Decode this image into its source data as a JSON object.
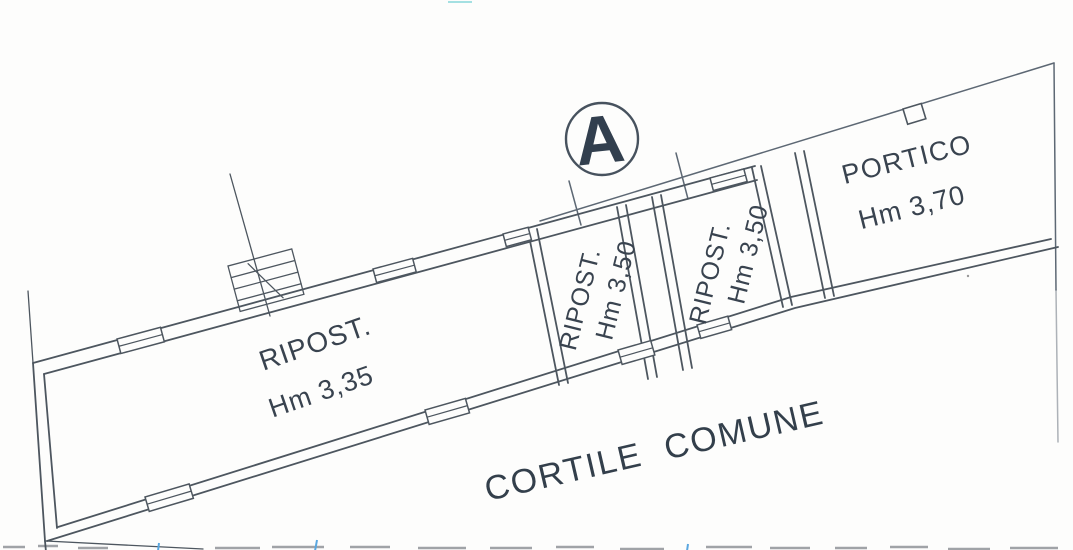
{
  "drawing": {
    "unit_badge": "A",
    "rooms": [
      {
        "label": "RIPOST.",
        "height": "Hm 3,35"
      },
      {
        "label": "RIPOST.",
        "height": "Hm 3,50"
      },
      {
        "label": "RIPOST.",
        "height": "Hm 3,50"
      },
      {
        "label": "PORTICO",
        "height": "Hm 3,70"
      }
    ],
    "courtyard_label": "CORTILE COMUNE"
  },
  "colors": {
    "wall_line": "#4d565f",
    "text": "#39434f",
    "badge_text": "#323f4e",
    "boundary_tick_blue": "#5aa7e0",
    "scan_cyan": "#7fd4d8"
  }
}
